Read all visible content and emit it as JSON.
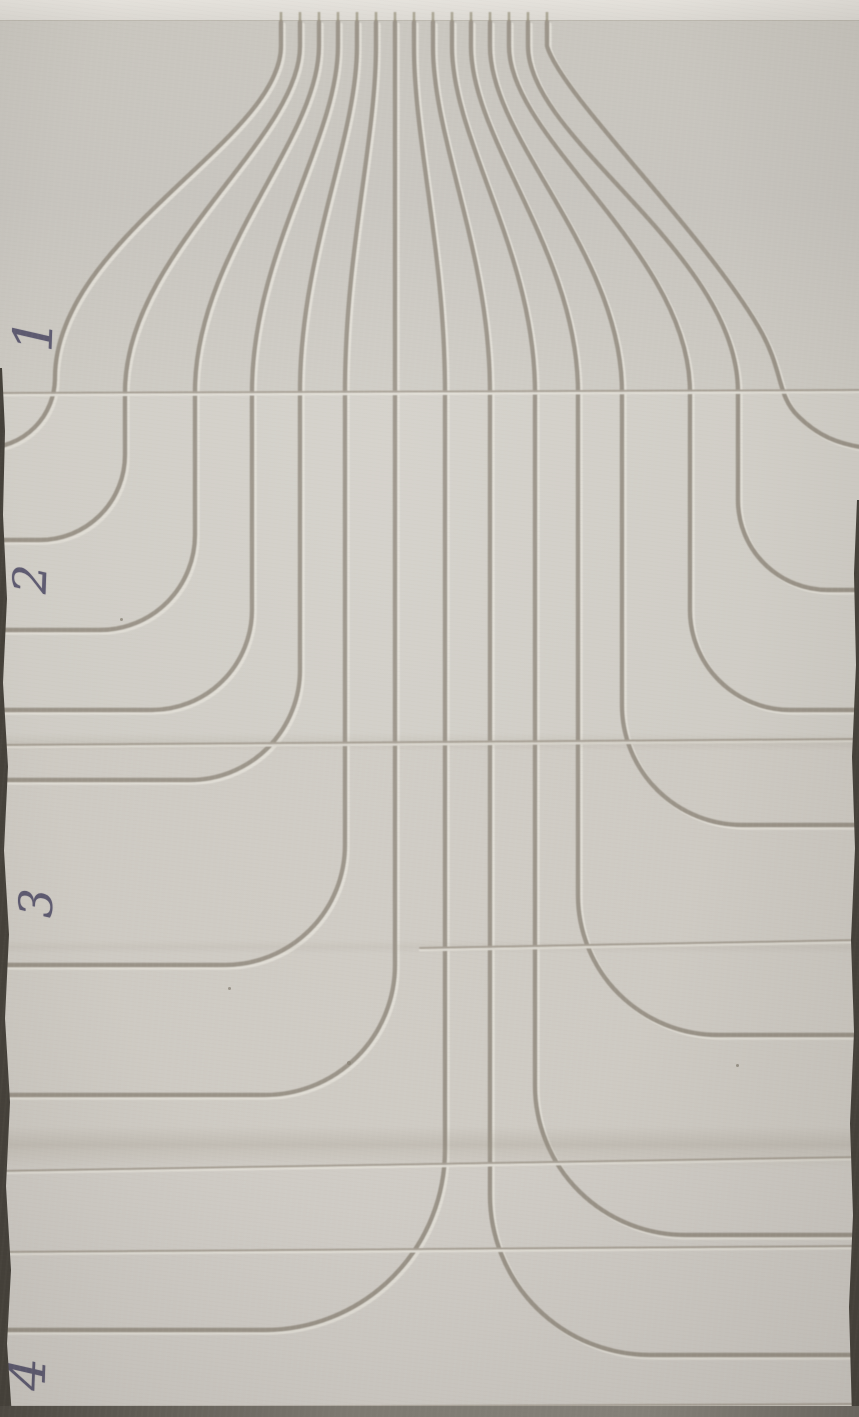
{
  "panels": [
    {
      "label": "1"
    },
    {
      "label": "2"
    },
    {
      "label": "3"
    },
    {
      "label": "4"
    }
  ],
  "channels": [
    {
      "side": "left",
      "top_x": 281,
      "vertical_x": 55,
      "bend_radius": 70,
      "exit_y": 448
    },
    {
      "side": "left",
      "top_x": 300,
      "vertical_x": 125,
      "bend_radius": 85,
      "exit_y": 540
    },
    {
      "side": "left",
      "top_x": 319,
      "vertical_x": 195,
      "bend_radius": 95,
      "exit_y": 630
    },
    {
      "side": "left",
      "top_x": 338,
      "vertical_x": 252,
      "bend_radius": 100,
      "exit_y": 710
    },
    {
      "side": "left",
      "top_x": 357,
      "vertical_x": 300,
      "bend_radius": 110,
      "exit_y": 780
    },
    {
      "side": "left",
      "top_x": 376,
      "vertical_x": 345,
      "bend_radius": 120,
      "exit_y": 965
    },
    {
      "side": "left",
      "top_x": 395,
      "vertical_x": 395,
      "bend_radius": 130,
      "exit_y": 1095
    },
    {
      "side": "left",
      "top_x": 414,
      "vertical_x": 445,
      "bend_radius": 180,
      "exit_y": 1330
    },
    {
      "side": "right",
      "top_x": 433,
      "vertical_x": 490,
      "bend_radius": 160,
      "exit_y": 1355
    },
    {
      "side": "right",
      "top_x": 452,
      "vertical_x": 535,
      "bend_radius": 150,
      "exit_y": 1235
    },
    {
      "side": "right",
      "top_x": 471,
      "vertical_x": 578,
      "bend_radius": 140,
      "exit_y": 1035
    },
    {
      "side": "right",
      "top_x": 490,
      "vertical_x": 622,
      "bend_radius": 120,
      "exit_y": 825
    },
    {
      "side": "right",
      "top_x": 509,
      "vertical_x": 690,
      "bend_radius": 100,
      "exit_y": 710
    },
    {
      "side": "right",
      "top_x": 528,
      "vertical_x": 738,
      "bend_radius": 90,
      "exit_y": 590
    },
    {
      "side": "right",
      "top_x": 547,
      "custom_path": "M 547 22 L 547 46 C 562 96 700 228 758 326 C 784 370 776 394 798 416 C 818 436 838 444 866 448"
    }
  ],
  "seams": [
    {
      "x1": -2,
      "y1": 393,
      "x2": 861,
      "y2": 390
    },
    {
      "x1": -2,
      "y1": 745,
      "x2": 861,
      "y2": 739
    },
    {
      "x1": 420,
      "y1": 948,
      "x2": 861,
      "y2": 940
    },
    {
      "x1": -2,
      "y1": 1171,
      "x2": 861,
      "y2": 1157
    },
    {
      "x1": -2,
      "y1": 1252,
      "x2": 861,
      "y2": 1246
    },
    {
      "x1": -2,
      "y1": 1408,
      "x2": 861,
      "y2": 1404
    }
  ],
  "colors": {
    "board": "#cdc9c3",
    "board_top_strip": "#e4e1db",
    "groove_shadow": "#9b9489",
    "groove_highlight": "#e2dfd7",
    "seam_shadow": "#a8a196",
    "ink": "#4a4763",
    "edge_dark": "#45413a",
    "bottom_edge": "#7d7973"
  }
}
